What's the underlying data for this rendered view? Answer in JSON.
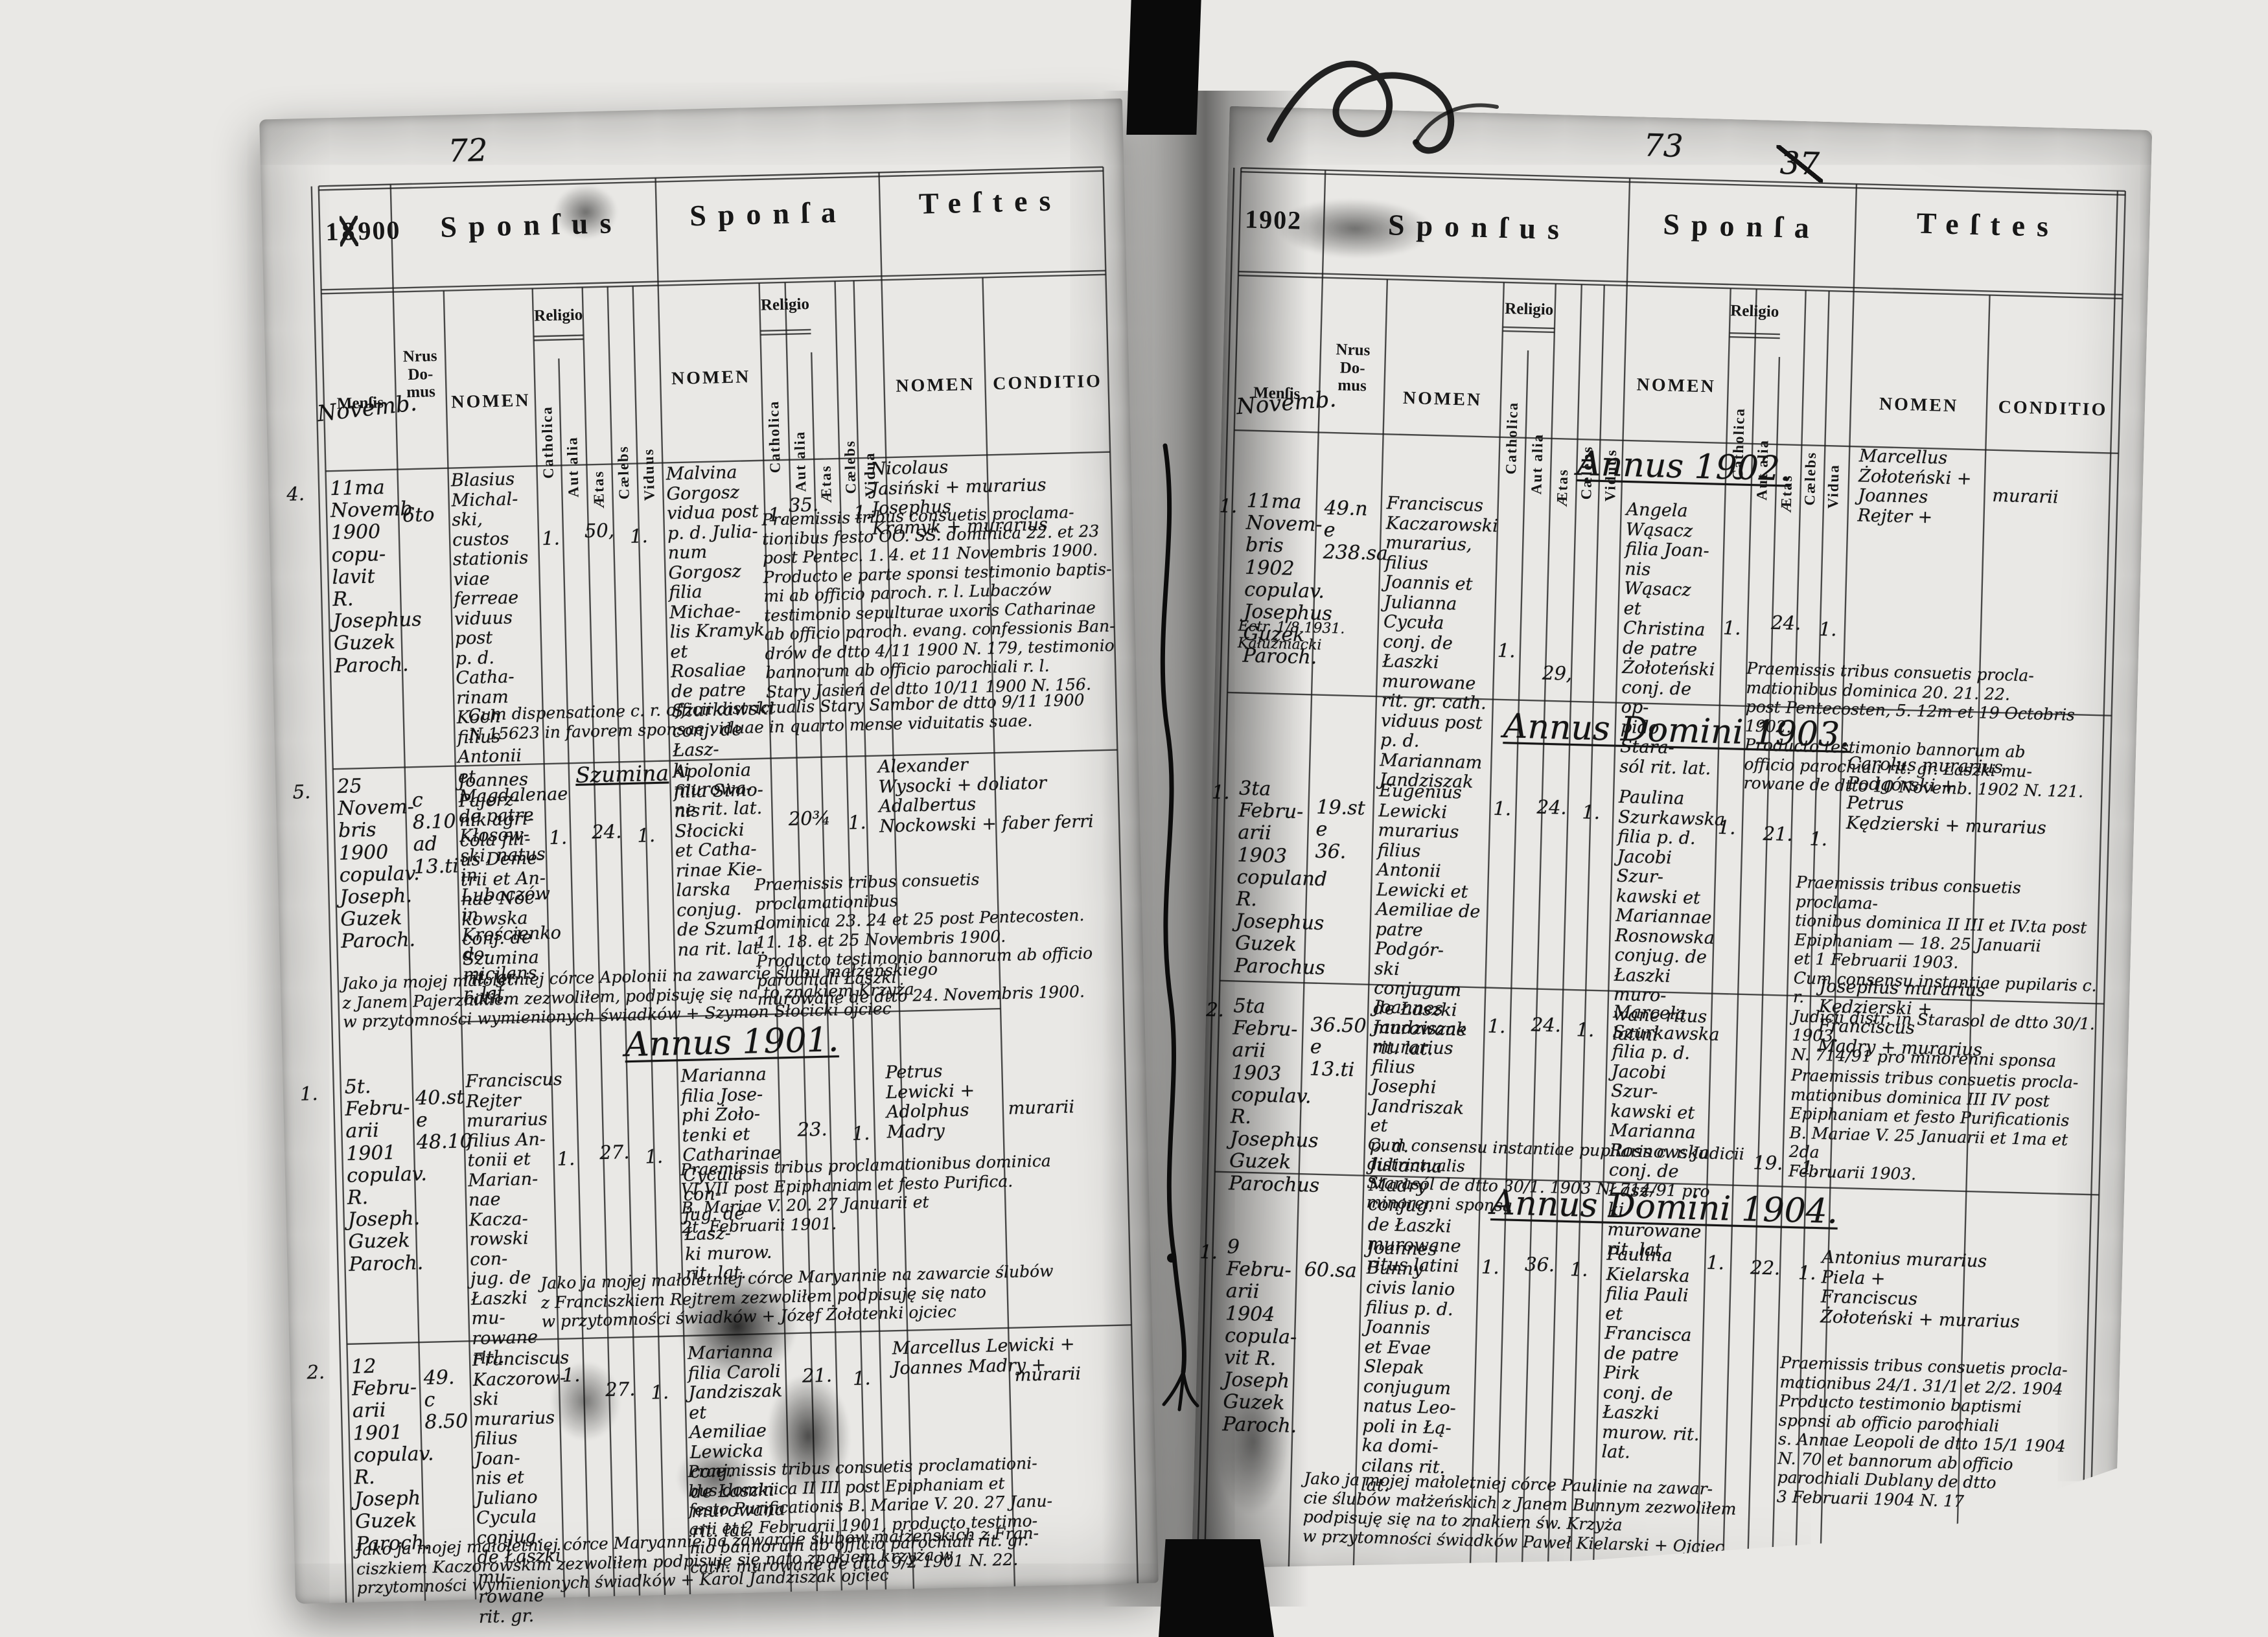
{
  "headers": {
    "sponsus": "Sponſus",
    "sponsa": "Sponſa",
    "testes": "Teſtes",
    "mensis": "Menſis",
    "nrus": "Nrus\nDo-\nmus",
    "nomen": "NOMEN",
    "religio": "Religio",
    "catholica": "Catholica",
    "aut_alia": "Aut alia",
    "aetas": "Ætas",
    "caelebs": "Cælebs",
    "viduus": "Viduus",
    "vidua": "Vidua",
    "conditio": "CONDITIO"
  },
  "left": {
    "folio": "72",
    "year_pre": "1",
    "year_struck": "8",
    "year_post": "900",
    "month": "Novemb.",
    "annus": "Annus 1901.",
    "records": [
      {
        "no": "4.",
        "mensis": "11ma\nNovemb\n1900 copu-\nlavit R.\nJosephus\nGuzek\nParoch.",
        "domus": "6to",
        "sponsus": "Blasius\nMichal-\nski, custos\nstationis\nviae ferreae\nviduus post\np. d. Catha-\nrinam Koch\nfilius Antonii\net Magdalenae\nde patre Kłosow-\nski, natus in\nLubaczów in\nKrościenko do-\nmicilans r. lat.",
        "sp_cath": "1.",
        "sp_aetas": "50,",
        "sp_status": "1.",
        "sponsa": "Malvina\nGorgosz\nvidua post\np. d. Julia-\nnum Gorgosz\nfilia Michae-\nlis Kramyk\net Rosaliae\nde patre\nSzurkawski\nconj. de Łasz-\nki murowa-\nne rit. lat.",
        "sa_cath": "1.",
        "sa_aetas": "35.",
        "sa_status": "1.",
        "testes": "Nicolaus\nJasiński + murarius\nJosephus\nKramyk + murarius",
        "note": "Praemissis tribus consuetis proclama-\ntionibus festo OO. SS. dominica 22. et 23\npost Pentec. 1. 4. et 11 Novembris 1900.\nProducto e parte sponsi testimonio baptis-\nmi ab officio paroch. r. l. Lubaczów\ntestimonio sepulturae uxoris Catharinae\nab officio paroch. evang. confessionis Ban-\ndrów de dtto 4/11 1900 N. 179, testimonio\nbannorum ab officio parochiali r. l.\nStary Jasień de dtto 10/11 1900 N. 156.",
        "note2": "Cum dispensatione c. r. officii districtualis Stary Sambor de dtto 9/11 1900\nN 15623 in favorem sponsae viduae in quarto mense viduitatis suae."
      },
      {
        "no": "5.",
        "mensis": "25 Novem-\nbris 1900\ncopulav.\nJoseph.\nGuzek\nParoch.",
        "domus": "c\n8.10\nad\n13.ti",
        "place_heading": "Szumina",
        "sponsus": "Joannes\nPajerz-\nnik agri-\ncola fili-\nus Deme-\ntrii et An-\nnae Noc-\nkowska\nconj. de\nSzumina\nrit. gr. cath.",
        "sp_cath": "1.",
        "sp_aetas": "24.",
        "sp_status": "1.",
        "sponsa": "Apolonia\nfilia Simo-\nnis Słocicki\net Catha-\nrinae Kie-\nlarska\nconjug.\nde Szumi-\nna rit. lat.",
        "sa_aetas": "20¾",
        "sa_status": "1.",
        "testes": "Alexander\nWysocki + doliator\nAdalbertus\nNockowski + faber ferri",
        "note": "Praemissis tribus consuetis proclamationibus\ndominica 23. 24 et 25 post Pentecosten.\n11. 18. et 25 Novembris 1900.\nProducto testimonio bannorum ab officio parochiali Łaszki\nmurowane de dtto 24. Novembris 1900.",
        "note2": "Jako ja mojej małoletniej córce Apolonii na zawarcie ślubu małżeńskiego\nz Janem Pajerznikiem zezwoliłem, podpisuję się na to znakiem Krzyża\nw przytomności wymienionych świadków + Szymon Słocicki ojciec"
      },
      {
        "no": "1.",
        "mensis": "5t. Febru-\narii 1901\ncopulav.\nR. Joseph.\nGuzek\nParoch.",
        "domus": "40.st\ne\n48.10",
        "sponsus": "Franciscus\nRejter\nmurarius\nfilius An-\ntonii et\nMarian-\nnae Kacza-\nrowski con-\njug. de\nŁaszki mu-\nrowane ritl.",
        "sp_cath": "1.",
        "sp_aetas": "27.",
        "sp_status": "1.",
        "sponsa": "Marianna\nfilia Jose-\nphi Żoło-\ntenki et\nCatharinae\nCycula con-\njug. de Łasz-\nki murow.\nrit. lat.",
        "sa_aetas": "23.",
        "sa_status": "1.",
        "testes": "Petrus\nLewicki +\nAdolphus\nMadry",
        "cond": "murarii",
        "note": "Praemissis tribus proclamationibus dominica\nVI VII post Epiphaniam et festo Purifica.\nB. Mariae V. 20. 27 Januarii et\n2t. Februarii 1901.",
        "note2": "Jako ja mojej małoletniej córce Maryannie na zawarcie ślubów\nz Franciszkiem Rejtrem zezwoliłem podpisuję się nato\nw przytomności świadków + Józef Żołotenki ojciec"
      },
      {
        "no": "2.",
        "mensis": "12 Febru-\narii 1901\ncopulav.\nR. Joseph\nGuzek\nParoch.",
        "domus": "49.\nc\n8.50",
        "sponsus": "Franciscus\nKaczorow-\nski murarius\nfilius Joan-\nnis et Juliano\nCycula conjug.\nde Łaszki mu-\nrowane rit. gr.",
        "sp_cath": "1.",
        "sp_aetas": "27.",
        "sp_status": "1.",
        "sponsa": "Marianna\nfilia Caroli\nJandziszak et\nAemiliae\nLewicka conj.\nde Łaszki\nmurowana\nrit. lat.",
        "sa_aetas": "21.",
        "sa_status": "1.",
        "testes": "Marcellus Lewicki +\nJoannes Madry +",
        "cond": "murarii",
        "note": "Praemissis tribus consuetis proclamationi-\nbus dominica II III post Epiphaniam et\nfesto Purificationis B. Mariae V. 20. 27 Janu-\narii et 2 Februarii 1901, producto testimo-\nnio bannorum ab officio parochiali rit. gr.\ncath. murowane de dtto 9/2 1901 N. 22.",
        "note2": "Jako ja mojej małoletniej córce Maryannie na zawarcie ślubów małżeńskich z Fran-\nciszkiem Kaczorowskim zezwoliłem podpisuję się nato znakiem krzyża w\nprzytomności wymienionych świadków +   Karol Jandziszak ojciec"
      }
    ]
  },
  "right": {
    "folio": "73",
    "folio_struck": "37",
    "year": "1902",
    "month": "Novemb.",
    "annus_1902": "Annus 1902.",
    "annus_1903": "Annus Domini 1903.",
    "annus_1904": "Annus Domini 1904.",
    "records": [
      {
        "no": "1.",
        "mensis": "11ma\nNovem-\nbris 1902\ncopulav.\nJosephus\nGuzek\nParoch.",
        "margin_note": "Ectr. 1/8 1931.\nKałużniacki",
        "domus": "49.n\ne\n238.sa",
        "sponsus": "Franciscus\nKaczarowski\nmurarius, filius\nJoannis et\nJulianna Cycuła\nconj. de Łaszki\nmurowane\nrit. gr. cath.\nviduus post\np. d. Mariannam\nJandziszak",
        "sp_cath": "1.",
        "sp_aetas": "29,",
        "sponsa": "Angela\nWąsacz\nfilia Joan-\nnis Wąsacz\net Christina\nde patre\nŻołoteński\nconj. de op-\npido Stara-\nsól rit. lat.",
        "sa_cath": "1.",
        "sa_aetas": "24.",
        "sa_status": "1.",
        "testes": "Marcellus\nŻołoteński +\nJoannes\nRejter +",
        "cond": "murarii",
        "note": "Praemissis tribus consuetis procla-\nmationibus dominica 20. 21. 22.\npost Pentecosten, 5. 12m et 19 Octobris 1902.\nProducto testimonio bannorum ab\nofficio parochiali rit. gr. Łaszki mu-\nrowane de dtto 10 Novemb. 1902 N. 121."
      },
      {
        "no": "1.",
        "mensis": "3ta Febru-\narii 1903\ncopuland\nR. Josephus\nGuzek\nParochus",
        "domus": "19.st\ne\n36.",
        "sponsus": "Eugenius\nLewicki\nmurarius\nfilius Antonii\nLewicki et\nAemiliae de\npatre Podgór-\nski conjugum\nde Łaszki\nmurowane\nrit. lat.",
        "sp_cath": "1.",
        "sp_aetas": "24.",
        "sp_status": "1.",
        "sponsa": "Paulina\nSzurkawska\nfilia p. d.\nJacobi Szur-\nkawski et\nMariannae\nRosnowska\nconjug. de\nŁaszki muro-\nwane ritus\nlatini",
        "sa_cath": "1.",
        "sa_aetas": "21.",
        "sa_status": "1.",
        "testes": "Carolus   murarius\nPodgórski +\nPetrus\nKędzierski + murarius",
        "note": "Praemissis tribus consuetis proclama-\ntionibus dominica II III et IV.ta post\nEpiphaniam — 18. 25 Januarii\net 1 Februarii 1903.\nCum consensu instantiae pupilaris c. r.\nJudicii distr. in Starasol de dtto 30/1. 1903.\nN. 714/91 pro minorenni sponsa"
      },
      {
        "no": "2.",
        "mensis": "5ta Febru-\narii 1903\ncopulav.\nR. Josephus\nGuzek\nParochus",
        "domus": "36.50\ne\n13.ti",
        "sponsus": "Joannes\nJandziszak\nmurarius\nfilius Josephi\nJandriszak et\np. d. Julianna\nMadry conjug.\nde Łaszki\nmurowane\nritus latini",
        "sp_cath": "1.",
        "sp_aetas": "24.",
        "sp_status": "1.",
        "sponsa": "Marcela\nSzurkawska\nfilia p. d.\nJacobi Szur-\nkawski et\nMarianna\nRosnowska\nconj. de Łasz-\nki murowane\nrit. lat.",
        "sa_aetas": "19.",
        "sa_status": "1.",
        "testes": "Josephus   murarius\nKędzierski +\nFranciscus\nMadry +   murarius",
        "note": "Praemissis tribus consuetis procla-\nmationibus dominica III IV post\nEpiphaniam et festo Purificationis\nB. Mariae V. 25 Januarii et 1ma et 2da\nFebruarii 1903.",
        "note2": "Cum consensu instantiae pupilaris c. r. Judicii districtualis\nStarasól de dtto 30/1. 1903 N. 714/91 pro minorenni sponsa"
      },
      {
        "no": "1.",
        "mensis": "9 Febru-\narii\n1904\ncopula-\nvit R.\nJoseph\nGuzek\nParoch.",
        "domus": "60.sa",
        "sponsus": "Joannes\nBunny\ncivis lanio\nfilius p. d.\nJoannis\net Evae\nSlepak\nconjugum\nnatus Leo-\npoli in Łą-\nka domi-\ncilans rit. lat.",
        "sp_cath": "1.",
        "sp_aetas": "36.",
        "sp_status": "1.",
        "sponsa": "Paulina\nKielarska\nfilia Pauli\net Francisca\nde patre Pirk\nconj. de Łaszki\nmurow. rit. lat.",
        "sa_cath": "1.",
        "sa_aetas": "22.",
        "sa_status": "1.",
        "testes": "Antonius   murarius\nPiela +\nFranciscus\nŻołoteński + murarius",
        "note": "Praemissis tribus consuetis procla-\nmationibus 24/1. 31/1 et 2/2. 1904\nProducto testimonio baptismi\nsponsi ab officio parochiali\ns. Annae Leopoli de dtto 15/1 1904\nN. 70 et bannorum ab officio\nparochiali Dublany de dtto\n3 Februarii 1904 N. 17",
        "note2": "Jako ja mojej małoletniej córce Paulinie na zawar-\ncie ślubów małżeńskich z Janem Bunnym zezwoliłem\npodpisuję się na to znakiem św. Krzyża\nw przytomności świadków Paweł Kielarski   + Ojciec"
      }
    ]
  }
}
